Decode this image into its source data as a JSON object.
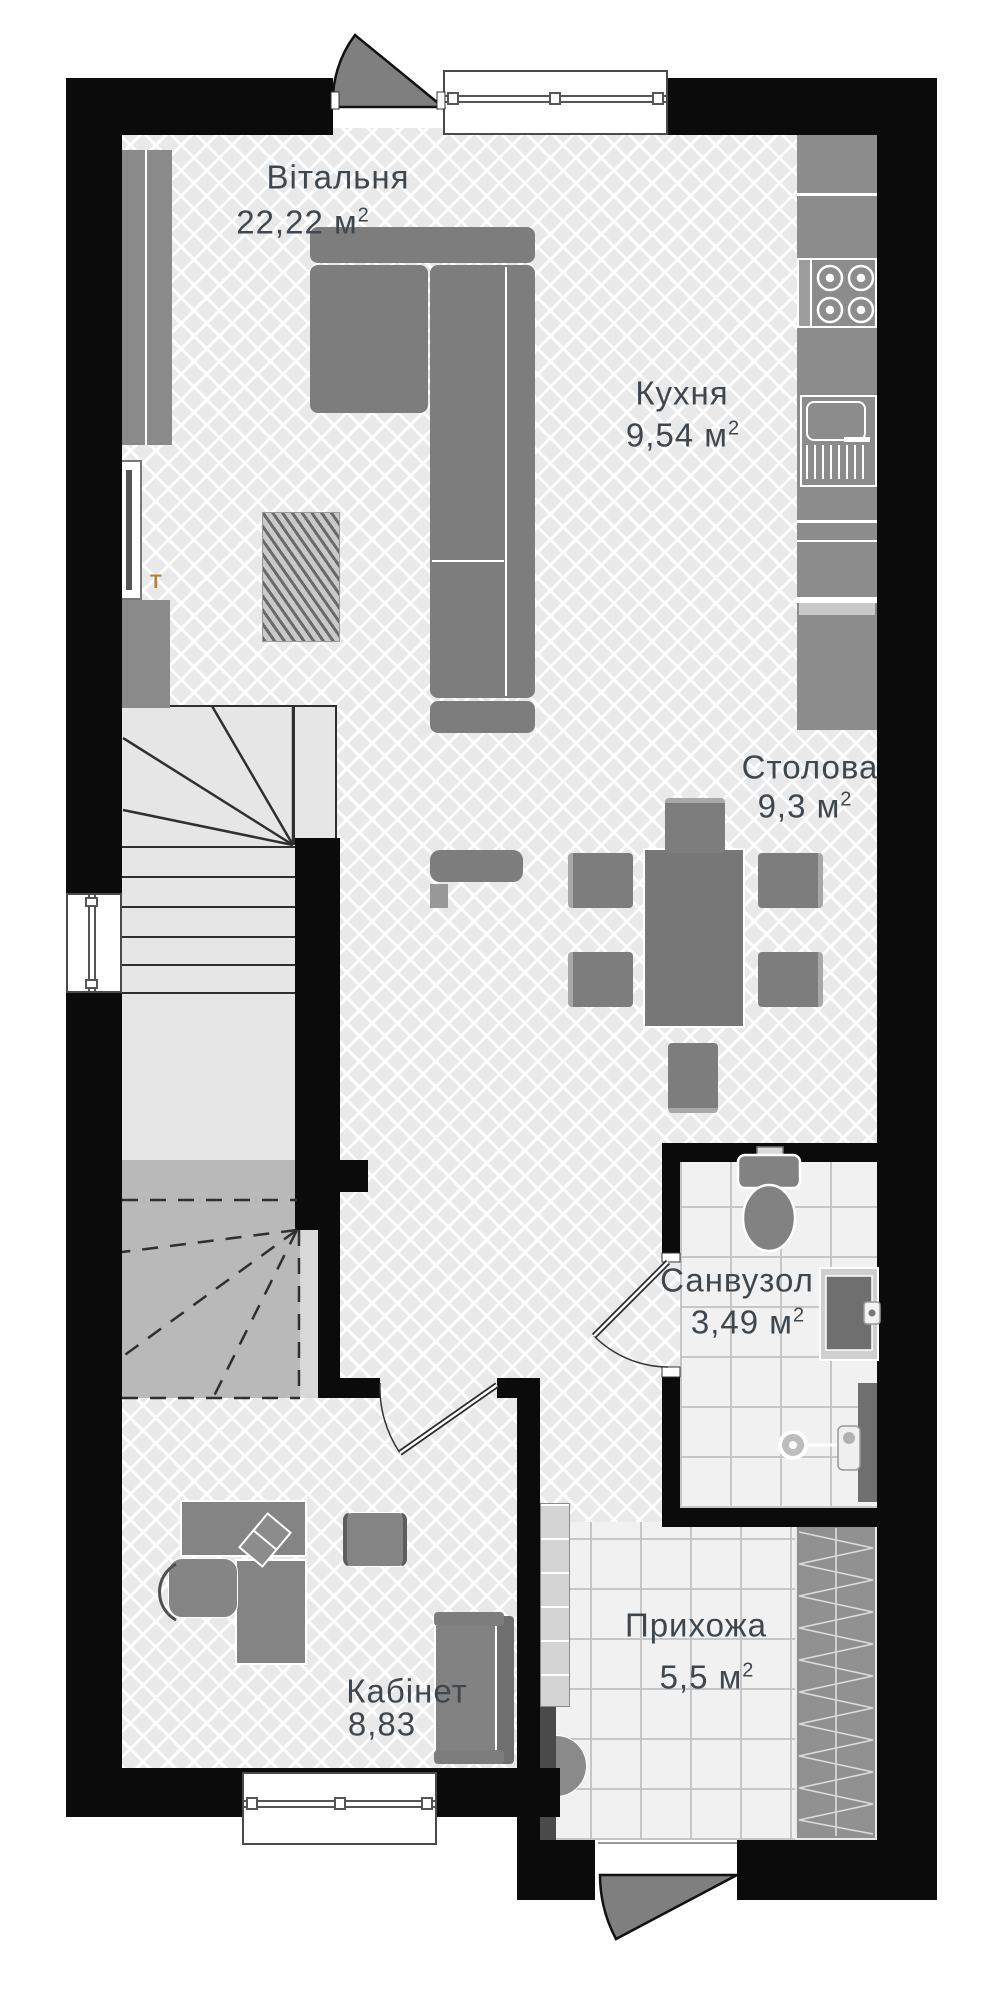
{
  "plan": {
    "title": "floor-plan",
    "rooms": [
      {
        "id": "living",
        "name": "Вітальня",
        "area": "22,22",
        "unit": "м",
        "unit_sup": "2"
      },
      {
        "id": "kitchen",
        "name": "Кухня",
        "area": "9,54",
        "unit": "м",
        "unit_sup": "2"
      },
      {
        "id": "dining",
        "name": "Столова",
        "area": "9,3",
        "unit": "м",
        "unit_sup": "2"
      },
      {
        "id": "bathroom",
        "name": "Санвузол",
        "area": "3,49",
        "unit": "м",
        "unit_sup": "2"
      },
      {
        "id": "hallway",
        "name": "Прихожа",
        "area": "5,5",
        "unit": "м",
        "unit_sup": "2"
      },
      {
        "id": "office",
        "name": "Кабінет",
        "area": "8,83",
        "unit": "",
        "unit_sup": ""
      }
    ],
    "markers": {
      "thermostat": "T"
    },
    "icons": [
      "stove-icon",
      "kitchen-sink-icon",
      "fridge-icon",
      "toilet-icon",
      "washbasin-icon",
      "shower-drain-icon",
      "wardrobe-icon",
      "stairs-icon",
      "door-swing-icon",
      "sofa-icon",
      "tv-icon",
      "dining-table-icon",
      "desk-icon",
      "rug-icon"
    ],
    "colors": {
      "wall": "#0b0b0b",
      "furniture": "#7d7d7d",
      "floor_base": "#e9e9e9",
      "tile": "#f1f1f1",
      "stair_light": "#e6e6e6",
      "stair_shaded": "#b9b9b9",
      "label_text": "#3f474e",
      "marker_accent": "#b5823c"
    }
  }
}
